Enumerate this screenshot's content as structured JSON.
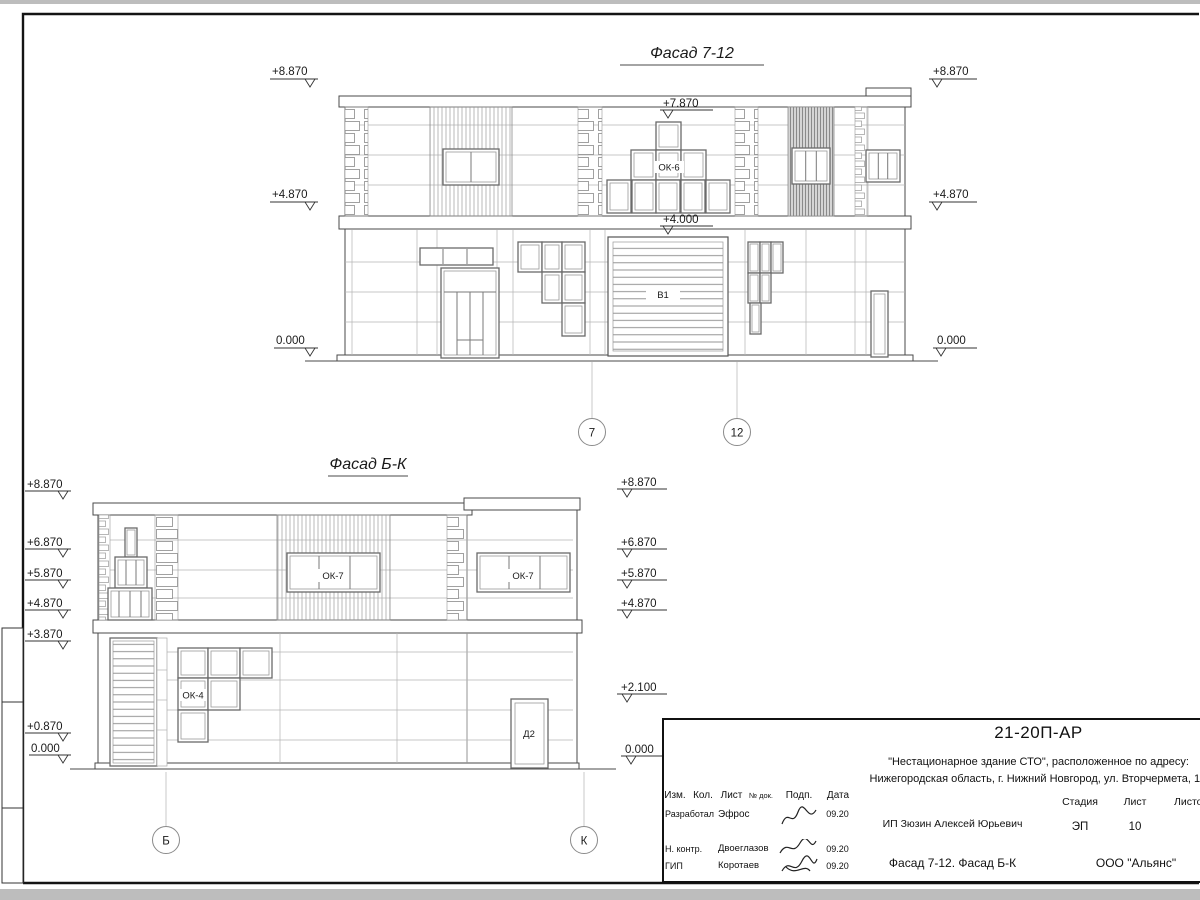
{
  "sheet": {
    "doc_number": "21-20П-АР",
    "project_name_line1": "\"Нестационарное здание СТО\", расположенное по адресу:",
    "project_name_line2": "Нижегородская область, г. Нижний Новгород, ул. Вторчермета, 1А",
    "client": "ИП Зюзин Алексей Юрьевич",
    "drawing_title": "Фасад 7-12. Фасад Б-К",
    "company": "ООО \"Альянс\"",
    "stage_label": "Стадия",
    "sheet_label": "Лист",
    "sheets_label": "Листов",
    "stage_value": "ЭП",
    "sheet_value": "10",
    "cols": {
      "izm": "Изм.",
      "kol": "Кол.",
      "list": "Лист",
      "ndok": "№ док.",
      "podp": "Подп.",
      "data": "Дата"
    },
    "rows": [
      {
        "role": "Разработал",
        "name": "Эфрос",
        "date": "09.20"
      },
      {
        "role": "Н. контр.",
        "name": "Двоеглазов",
        "date": "09.20"
      },
      {
        "role": "ГИП",
        "name": "Коротаев",
        "date": "09.20"
      }
    ]
  },
  "facade_top": {
    "title": "Фасад 7-12",
    "marks_left": [
      "+8.870",
      "+4.870",
      "0.000"
    ],
    "marks_right": [
      "+8.870",
      "+4.870",
      "0.000"
    ],
    "mark_window": "+7.870",
    "mark_gate": "+4.000",
    "window_label": "ОК-6",
    "gate_label": "В1",
    "axis_left": "7",
    "axis_right": "12"
  },
  "facade_bottom": {
    "title": "Фасад Б-К",
    "marks_left": [
      "+8.870",
      "+6.870",
      "+5.870",
      "+4.870",
      "+3.870",
      "+0.870",
      "0.000"
    ],
    "marks_right": [
      "+8.870",
      "+6.870",
      "+5.870",
      "+4.870",
      "+2.100",
      "0.000"
    ],
    "window_label": "ОК-7",
    "window_label_2": "ОК-7",
    "window_label_lower": "ОК-4",
    "door_label": "Д2",
    "axis_left": "Б",
    "axis_right": "К"
  }
}
